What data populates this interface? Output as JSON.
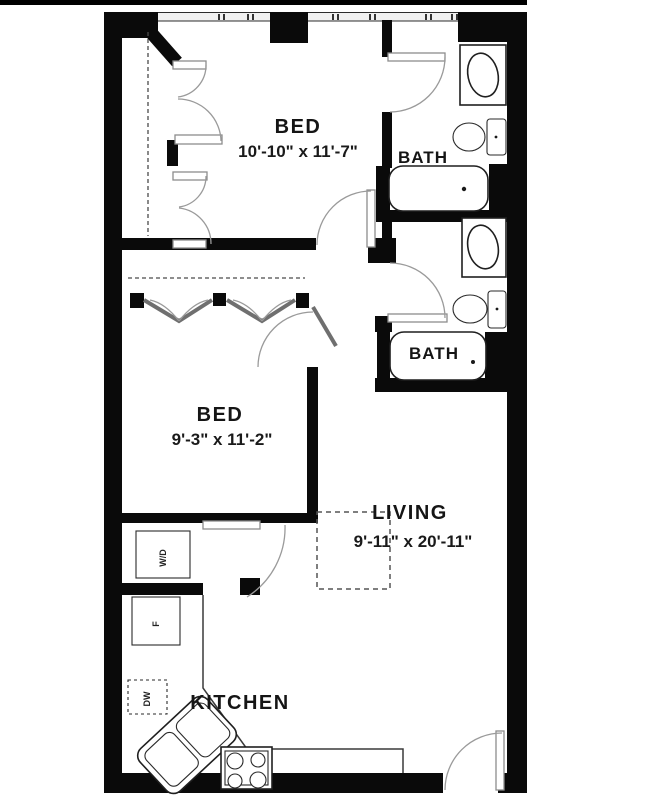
{
  "plan": {
    "title": "two-bed two-bath apartment floor plan",
    "rooms": {
      "bed1": {
        "name": "BED",
        "dims": "10'-10\" x 11'-7\""
      },
      "bed2": {
        "name": "BED",
        "dims": "9'-3\" x 11'-2\""
      },
      "living": {
        "name": "LIVING",
        "dims": "9'-11\" x 20'-11\""
      },
      "kitchen": {
        "name": "KITCHEN"
      },
      "bath_upper": {
        "name": "BATH"
      },
      "bath_lower": {
        "name": "BATH"
      }
    },
    "appliances": {
      "washer_dryer": "W/D",
      "fridge": "F",
      "dishwasher": "DW"
    },
    "colors": {
      "wall": "#0a0a0a",
      "background": "#ffffff",
      "fixture_stroke": "#1f1f1f",
      "door_arc": "#9a9a9a"
    }
  }
}
